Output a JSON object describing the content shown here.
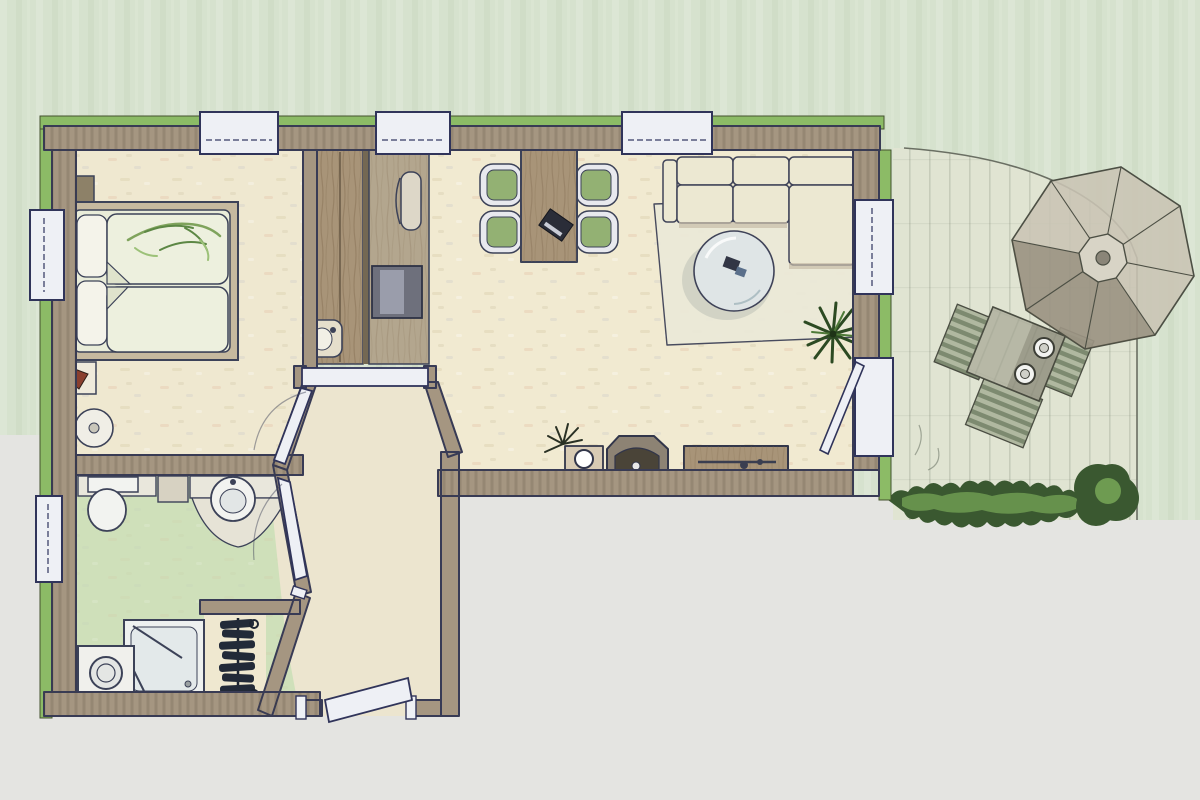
{
  "meta": {
    "title": "apartment-floor-plan",
    "style": "hand-rendered watercolor architectural plan, top view",
    "canvas": {
      "width": 1200,
      "height": 800
    }
  },
  "palette": {
    "background_green": "#d6e2ce",
    "background_gray": "#e4e4e1",
    "wall": "#a59681",
    "wall_outline": "#383b55",
    "accent_green": "#8cbb66",
    "floor_main": "#f1ead1",
    "floor_bedroom": "#efe8d0",
    "floor_bath": "#cfe0ba",
    "floor_hall": "#ece5cf",
    "terrace": "#e0e4d2",
    "window_white": "#eef0f5",
    "wood": "#a89478",
    "wood_dark": "#746853",
    "hedge_dark": "#3a5830",
    "hedge_light": "#6e9b51",
    "sofa": "#ece8d2",
    "chair_seat": "#93b173",
    "umbrella": "#c9c4b4",
    "appliance_gray": "#6e707c",
    "fixture_white": "#f2f3f0"
  },
  "rooms": [
    {
      "id": "bedroom",
      "position": "top-left",
      "floor": "cream"
    },
    {
      "id": "bathroom",
      "position": "bottom-left",
      "floor": "green"
    },
    {
      "id": "entry-hall",
      "position": "bottom-center",
      "floor": "cream"
    },
    {
      "id": "living-dining-room",
      "position": "center-right",
      "floor": "cream"
    },
    {
      "id": "terrace",
      "position": "far-right",
      "floor": "pale-green paving"
    }
  ],
  "openings": {
    "windows": [
      {
        "id": "top-window-1",
        "wall": "north",
        "over": "bedroom"
      },
      {
        "id": "top-window-2",
        "wall": "north",
        "over": "kitchenette"
      },
      {
        "id": "top-window-3",
        "wall": "north",
        "over": "dining-area"
      },
      {
        "id": "left-window-bedroom",
        "wall": "west"
      },
      {
        "id": "left-window-bathroom",
        "wall": "west"
      },
      {
        "id": "right-window-living",
        "wall": "east"
      }
    ],
    "doors": [
      {
        "id": "bedroom-door",
        "between": [
          "entry-hall",
          "bedroom"
        ]
      },
      {
        "id": "bathroom-door",
        "between": [
          "entry-hall",
          "bathroom"
        ]
      },
      {
        "id": "terrace-door",
        "between": [
          "living-dining-room",
          "terrace"
        ]
      },
      {
        "id": "entry-door",
        "between": [
          "outside",
          "entry-hall"
        ]
      },
      {
        "id": "living-opening-beam",
        "between": [
          "entry-hall",
          "living-dining-room"
        ]
      }
    ]
  },
  "furniture": {
    "bedroom": [
      "double-bed with two pillows and two duvets",
      "green foliage sprig on bed",
      "corner shelf",
      "nightstand with lamp",
      "round stool",
      "wardrobe",
      "corner-fixture"
    ],
    "kitchenette_strip": [
      "tall cabinet",
      "sink",
      "refrigerator"
    ],
    "bathroom": [
      "toilet with cistern",
      "round washbasin on counter",
      "vanity counter",
      "shower cabin with glass door",
      "washing machine",
      "radiator in niche"
    ],
    "living_dining": [
      "dining table",
      "four chairs with green seats",
      "laptop on table",
      "corner sofa",
      "area rug",
      "round glass coffee table",
      "potted palm plant",
      "spiky decorative plant",
      "pedestal with bowl",
      "stove-fireplace unit",
      "sideboard with long handle"
    ],
    "terrace": [
      "octagonal parasol",
      "square patio table",
      "two cups on table",
      "three striped loungers",
      "hedge row",
      "round bush"
    ]
  }
}
